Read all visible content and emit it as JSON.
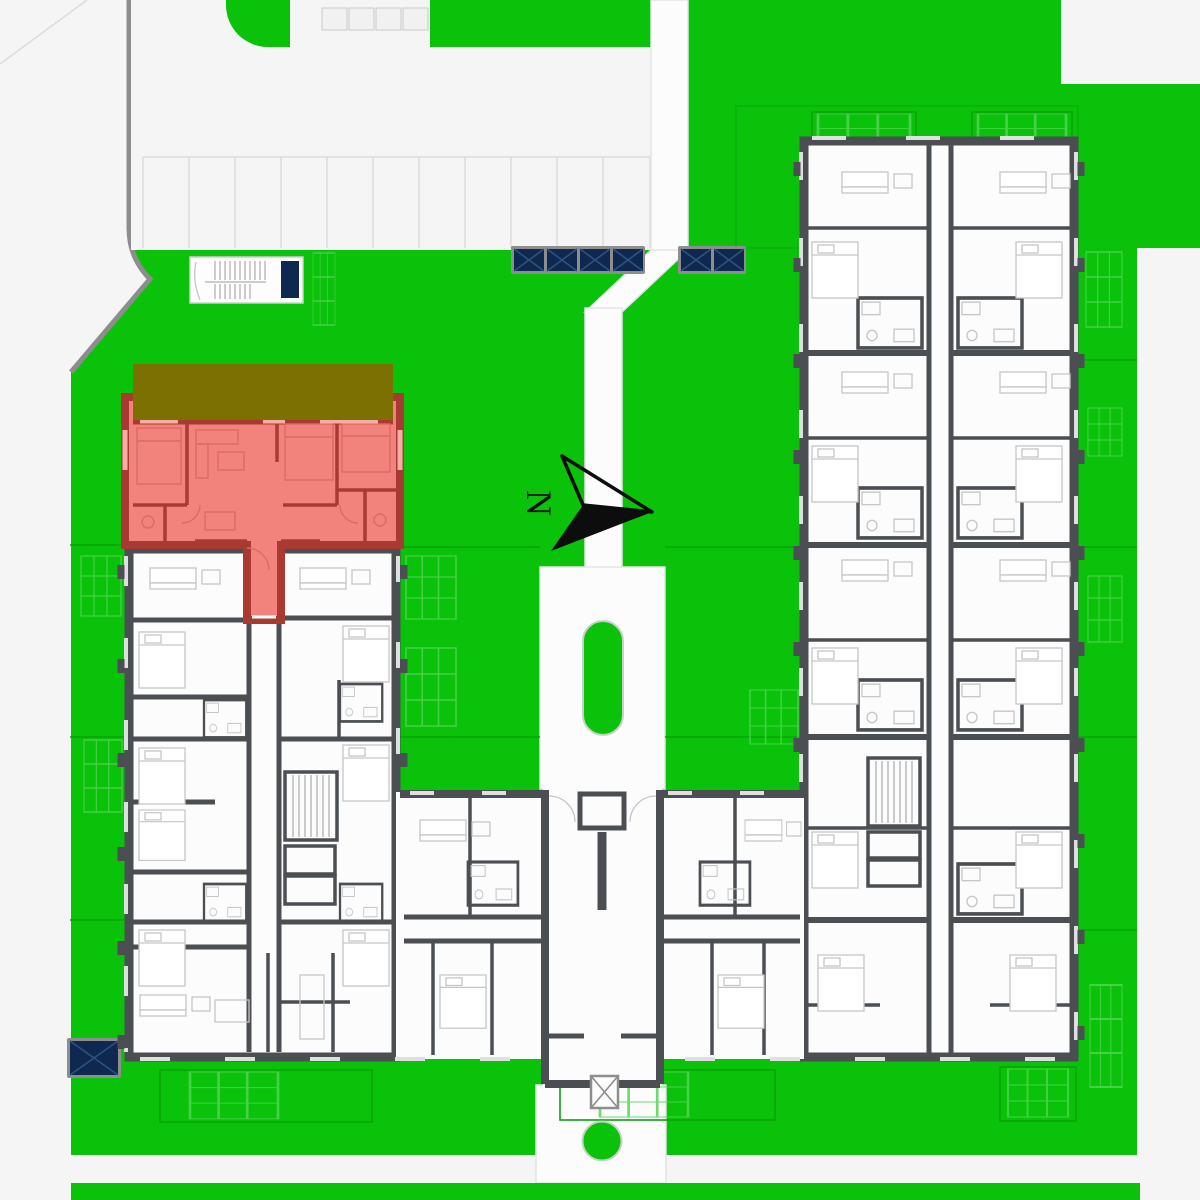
{
  "compass": {
    "label": "N"
  },
  "features": {
    "skylight_group_west_count": 4,
    "skylight_group_east_count": 2,
    "highlighted_unit_present": true
  },
  "colors": {
    "lawn": "#0bc20b",
    "lawn_line": "#09a309",
    "lawn_grid": "#52d452",
    "road": "#f5f5f6",
    "road_line": "#dcdcdc",
    "curb": "#8d8d8d",
    "plaza": "#fcfcfc",
    "plaza_edge": "#e3e3e3",
    "wall": "#4b4e52",
    "room": "#fcfcfc",
    "furniture": "#c6c6c6",
    "window": "#dfdfdf",
    "highlight_fill": "#f2837c",
    "highlight_wall": "#a93a31",
    "highlight_furniture": "#dd6a62",
    "highlight_window": "#f5ada6",
    "terrace": "#7c7003",
    "navy": "#0e2850",
    "navy_line": "#2e5280",
    "frame": "#8e8e8e",
    "arrow": "#0d0d0d",
    "island_edge": "#c9d0c9"
  }
}
